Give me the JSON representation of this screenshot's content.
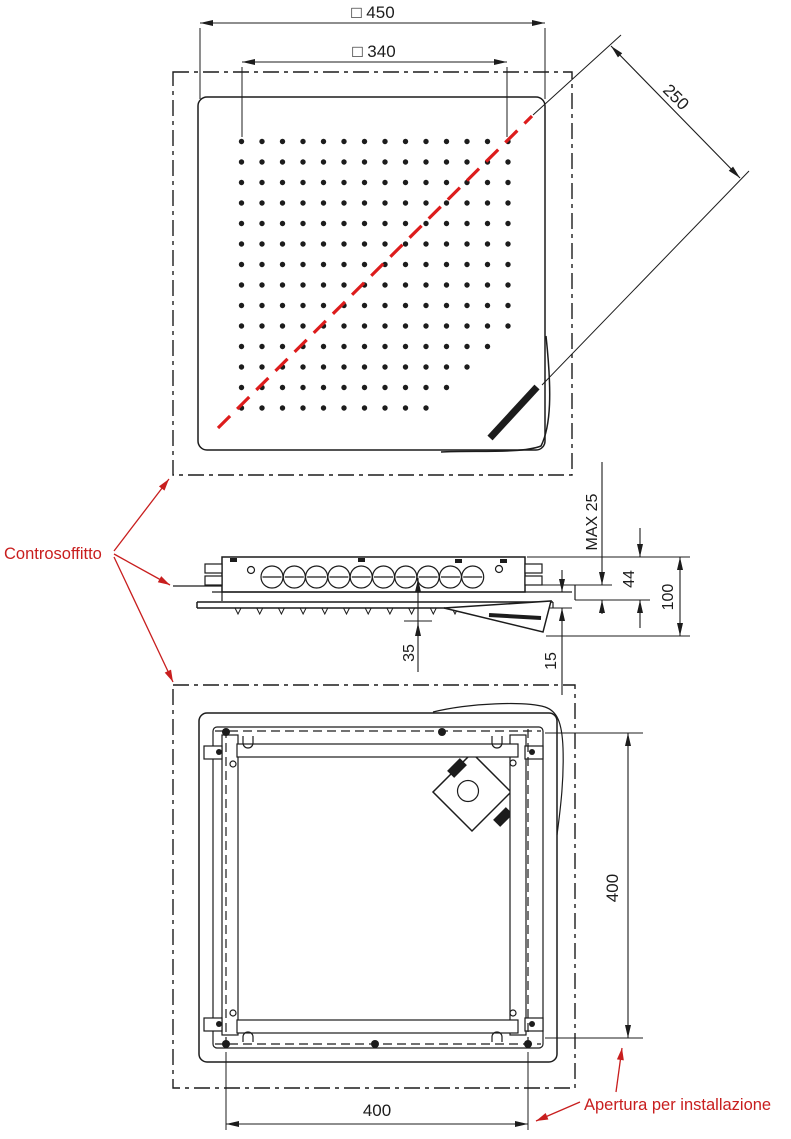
{
  "colors": {
    "ink": "#1c1c1c",
    "red": "#c81e1e",
    "diagonal_red": "#dd1c1c",
    "paper": "#ffffff"
  },
  "annotations": {
    "controsoffitto": "Controsoffitto",
    "apertura": "Apertura per installazione"
  },
  "top_view": {
    "dim_square_450": "□ 450",
    "dim_square_340": "□ 340",
    "dim_diagonal_250": "250",
    "nozzle_grid": {
      "x0": 241.5,
      "y0": 141.5,
      "dx": 20.5,
      "dy": 20.5,
      "r": 2.7,
      "row_last_col": [
        14,
        14,
        14,
        14,
        14,
        14,
        14,
        14,
        14,
        14,
        13,
        12,
        11,
        10
      ]
    }
  },
  "section_view": {
    "dim_max_ceiling": "MAX 25",
    "dim_above_ceiling": "44",
    "dim_total_depth": "100",
    "dim_tube_to_nozzle": "35",
    "dim_spout_drop": "15",
    "tube_row": {
      "x0": 272,
      "dx": 22.3,
      "n": 10,
      "cy": 577,
      "r": 11
    },
    "nozzle_row": {
      "x0": 238,
      "dx": 21.7,
      "n": 14,
      "y": 608,
      "h": 6,
      "w": 6
    }
  },
  "bottom_view": {
    "dim_opening_width": "400",
    "dim_opening_height": "400"
  }
}
